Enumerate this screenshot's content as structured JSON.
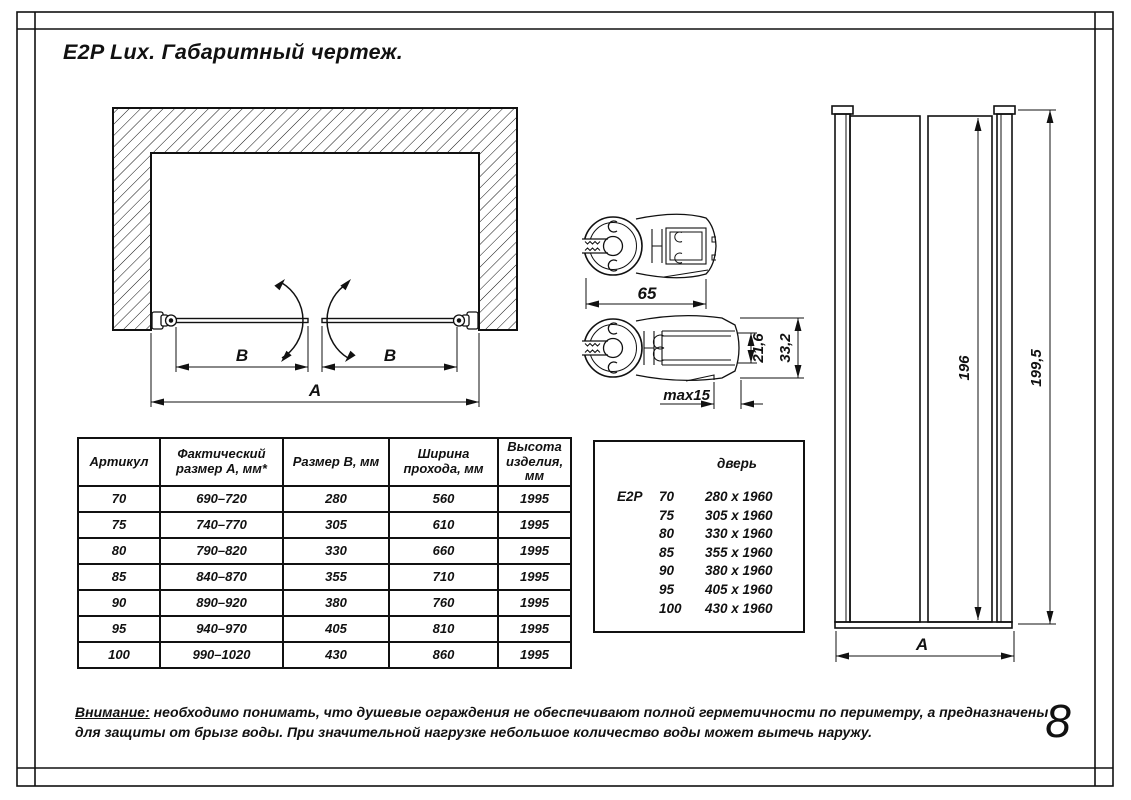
{
  "sheet": {
    "title": "E2P Lux. Габаритный чертеж.",
    "page_number": "8"
  },
  "note": {
    "label": "Внимание:",
    "line1_rest": "необходимо понимать, что душевые ограждения не обеспечивают полной герметичности по периметру, а предназначены",
    "line2": "для защиты от брызг воды. При значительной нагрузке небольшое количество воды может вытечь наружу."
  },
  "plan_view": {
    "dim_b_left": "B",
    "dim_b_right": "B",
    "dim_a": "A"
  },
  "profile_top": {
    "dim_width": "65"
  },
  "profile_side": {
    "dim_slot_depth": "21,6",
    "dim_height": "33,2",
    "dim_adjust": "max15"
  },
  "front_view": {
    "dim_door_height": "196",
    "dim_total_height": "199,5",
    "dim_width": "A"
  },
  "size_table": {
    "headers": [
      "Артикул",
      "Фактический размер А, мм*",
      "Размер В, мм",
      "Ширина прохода, мм",
      "Высота изделия, мм"
    ],
    "rows": [
      [
        "70",
        "690–720",
        "280",
        "560",
        "1995"
      ],
      [
        "75",
        "740–770",
        "305",
        "610",
        "1995"
      ],
      [
        "80",
        "790–820",
        "330",
        "660",
        "1995"
      ],
      [
        "85",
        "840–870",
        "355",
        "710",
        "1995"
      ],
      [
        "90",
        "890–920",
        "380",
        "760",
        "1995"
      ],
      [
        "95",
        "940–970",
        "405",
        "810",
        "1995"
      ],
      [
        "100",
        "990–1020",
        "430",
        "860",
        "1995"
      ]
    ]
  },
  "door_box": {
    "header": "дверь",
    "series": "E2P",
    "rows": [
      {
        "size": "70",
        "glass": "280 x 1960"
      },
      {
        "size": "75",
        "glass": "305 x 1960"
      },
      {
        "size": "80",
        "glass": "330 x 1960"
      },
      {
        "size": "85",
        "glass": "355 x 1960"
      },
      {
        "size": "90",
        "glass": "380 x 1960"
      },
      {
        "size": "95",
        "glass": "405 x 1960"
      },
      {
        "size": "100",
        "glass": "430 x 1960"
      }
    ]
  }
}
